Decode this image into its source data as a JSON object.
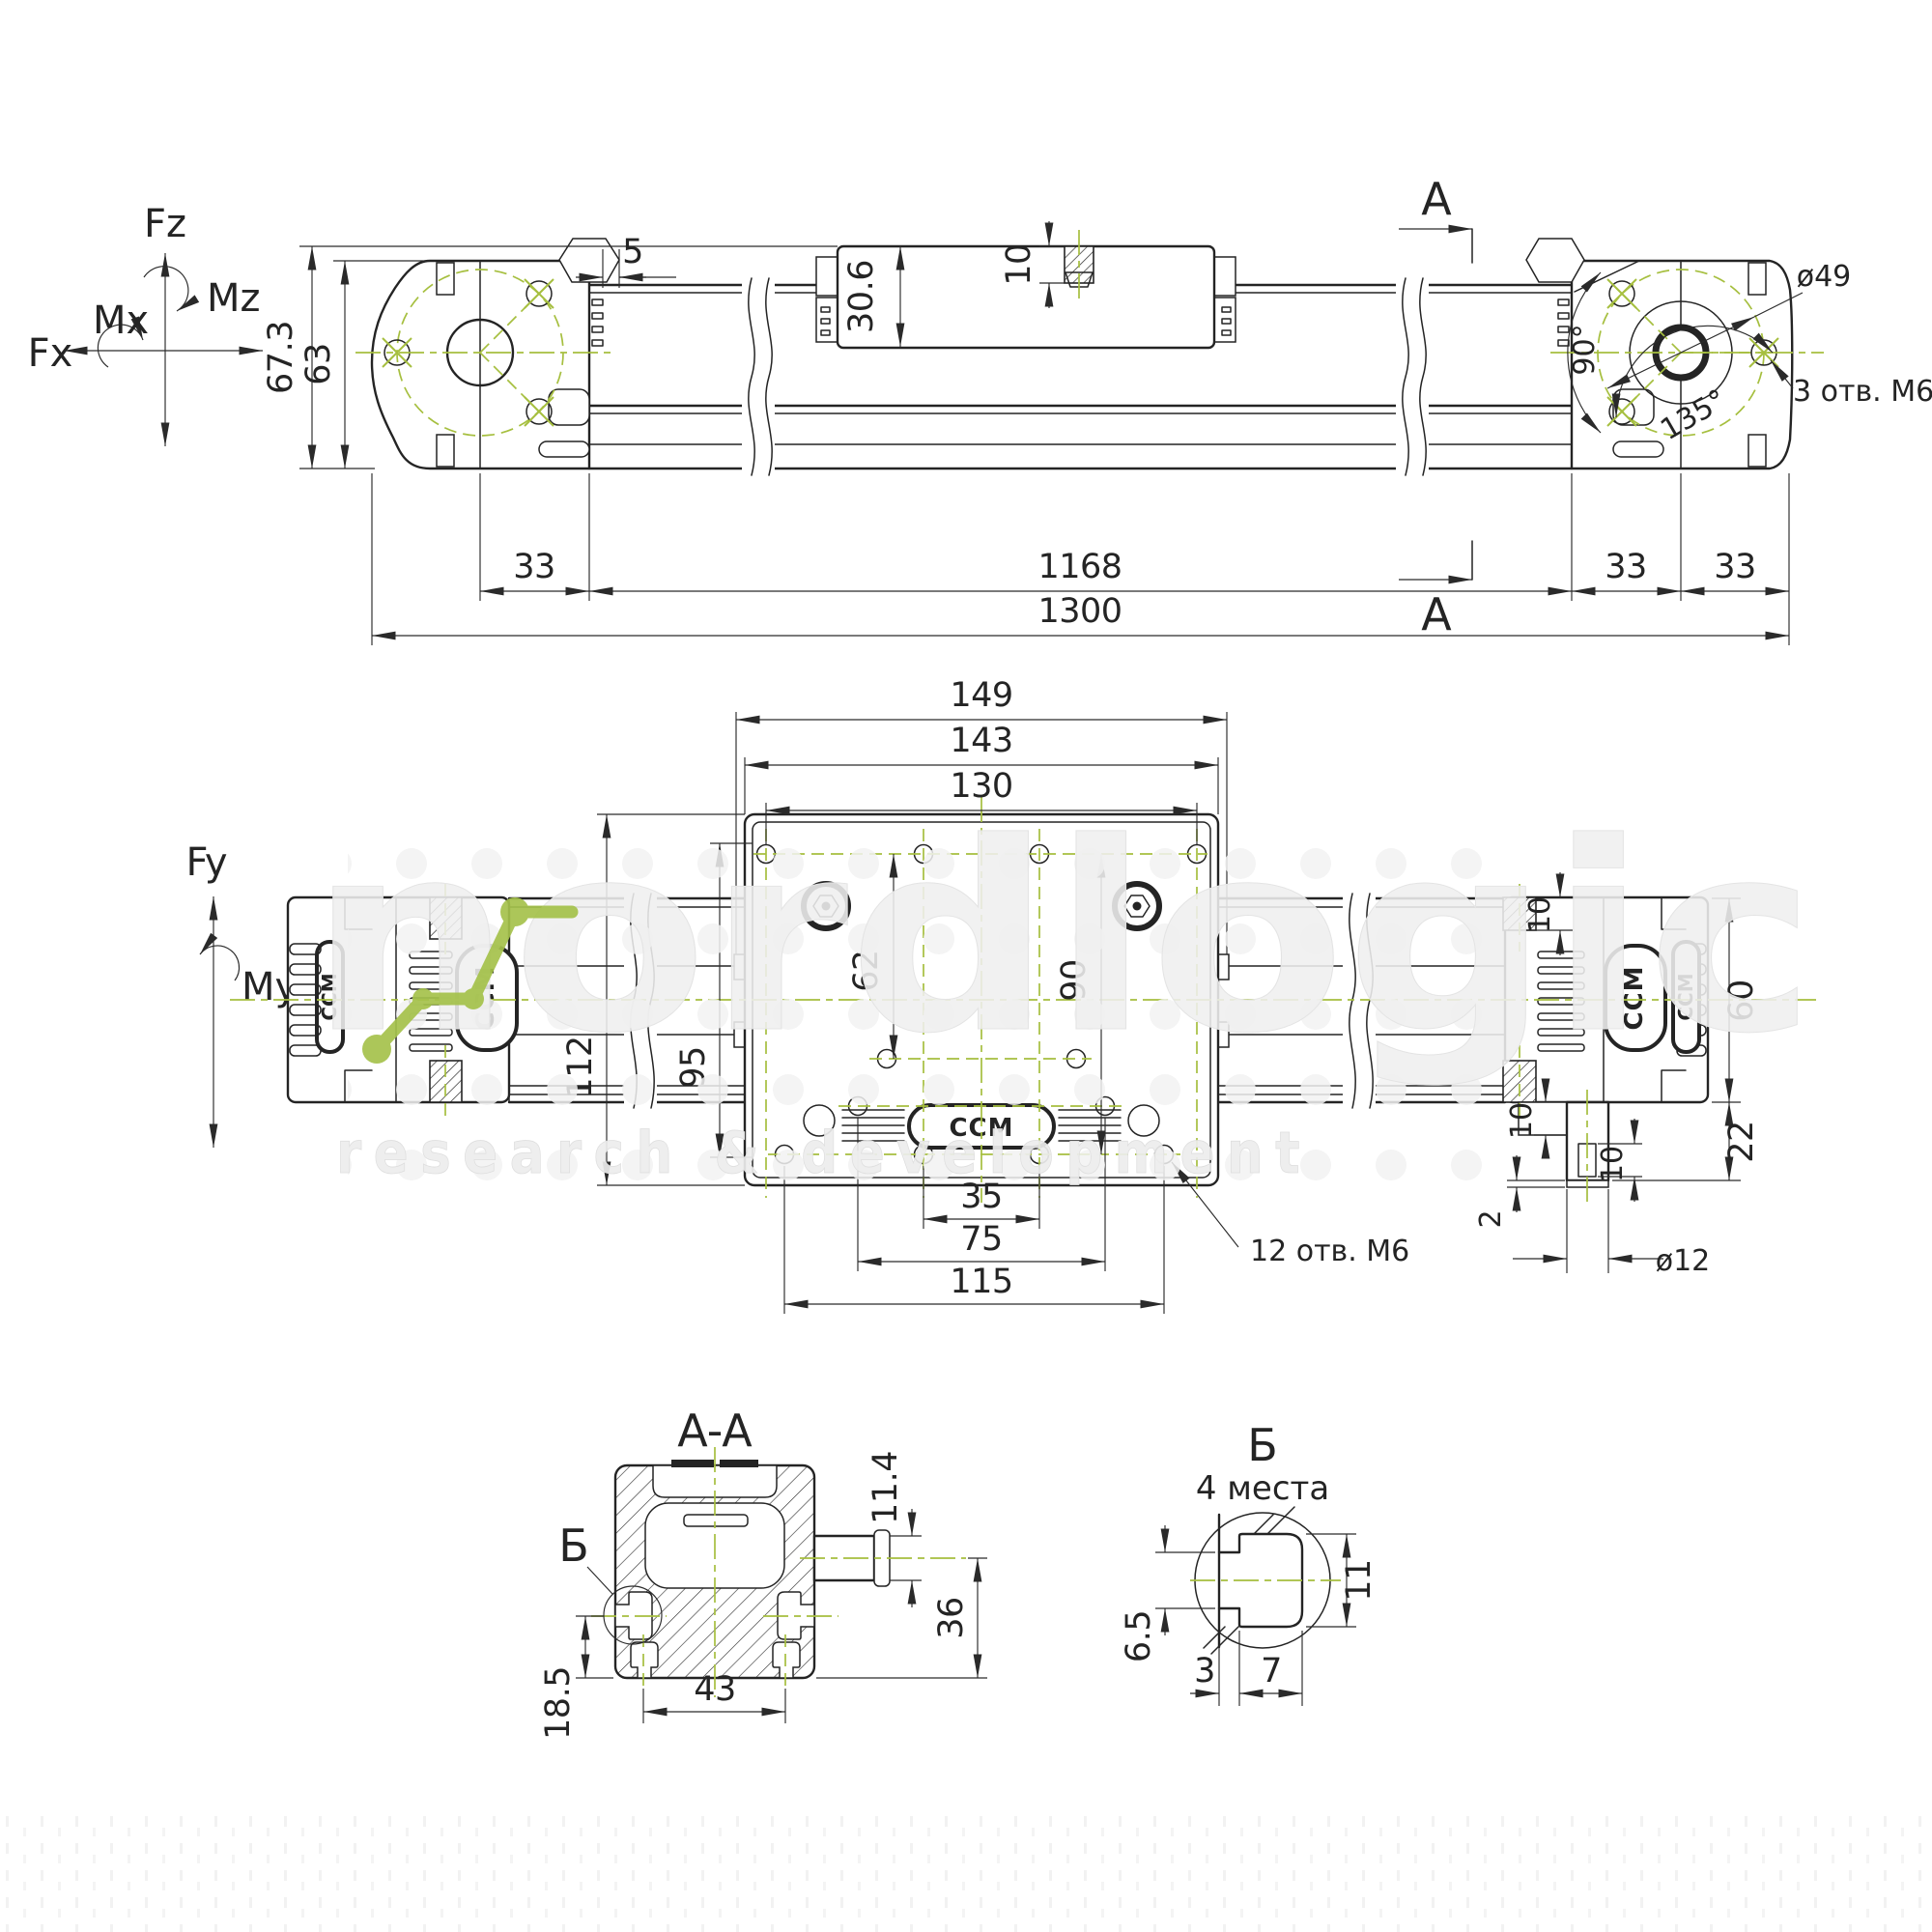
{
  "colors": {
    "ink": "#242424",
    "centerline_green": "#a6bf3f",
    "logo_green": "#a5c24b"
  },
  "axes": {
    "fz": "Fz",
    "mz": "Mz",
    "mx": "Mx",
    "fx": "Fx",
    "fy": "Fy",
    "my": "My"
  },
  "top_view": {
    "d_total_h": "67.3",
    "d_body_h": "63",
    "d_offset": "5",
    "d_carriage_h": "30.6",
    "d_slot_depth": "10",
    "d_left": "33",
    "d_stroke": "1168",
    "d_right1": "33",
    "d_right2": "33",
    "d_total": "1300",
    "d_bolt_circle": "ø49",
    "a90": "90°",
    "a135": "135°",
    "holes_note": "3 отв. М6",
    "section": "A"
  },
  "plan_view": {
    "d149": "149",
    "d143": "143",
    "d130": "130",
    "d112": "112",
    "d95": "95",
    "d62": "62",
    "d90": "90",
    "d35": "35",
    "d75": "75",
    "d115": "115",
    "holes_note": "12 отв. М6",
    "d10_top": "10",
    "d60": "60",
    "d22": "22",
    "d10_step": "10",
    "d10_key": "10",
    "d2": "2",
    "d_shaft": "ø12"
  },
  "section_aa": {
    "title": "A-A",
    "d_shaft": "11.4",
    "d36": "36",
    "d43": "43",
    "d185": "18.5",
    "detail_mark": "Б"
  },
  "detail_b": {
    "title": "Б",
    "places": "4 места",
    "d65": "6.5",
    "d3": "3",
    "d7": "7",
    "d11": "11"
  },
  "watermark": {
    "name": "nordlogic",
    "tagline": "research & development"
  },
  "brand": {
    "logo": "CCM"
  }
}
